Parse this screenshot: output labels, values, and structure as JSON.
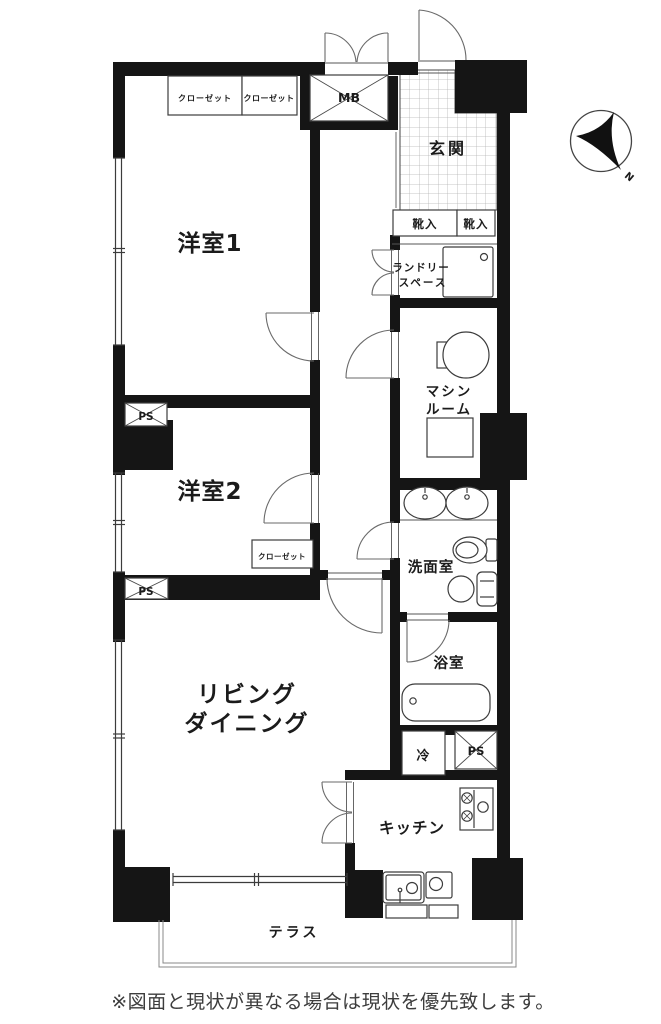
{
  "plan": {
    "labels": {
      "closet_a": "クローゼット",
      "closet_b": "クローゼット",
      "mb": "MB",
      "entrance": "玄関",
      "shoe_a": "靴入",
      "shoe_b": "靴入",
      "room1": "洋室1",
      "laundry_1": "ランドリー",
      "laundry_2": "スペース",
      "machine_1": "マシン",
      "machine_2": "ルーム",
      "ps_a": "PS",
      "room2": "洋室2",
      "closet_c": "クローゼット",
      "washroom": "洗面室",
      "ps_b": "PS",
      "bathroom": "浴室",
      "living_1": "リビング",
      "living_2": "ダイニング",
      "fridge": "冷",
      "ps_c": "PS",
      "kitchen": "キッチン",
      "terrace": "テラス"
    },
    "compass": {
      "north": "N"
    },
    "note": "※図面と現状が異なる場合は現状を優先致します。",
    "colors": {
      "wall": "#151515",
      "line": "#3c3c3c",
      "door": "#6a6a6a",
      "tile_grid": "#b5b5b5",
      "terrace_line": "#888888",
      "background": "#ffffff"
    }
  }
}
